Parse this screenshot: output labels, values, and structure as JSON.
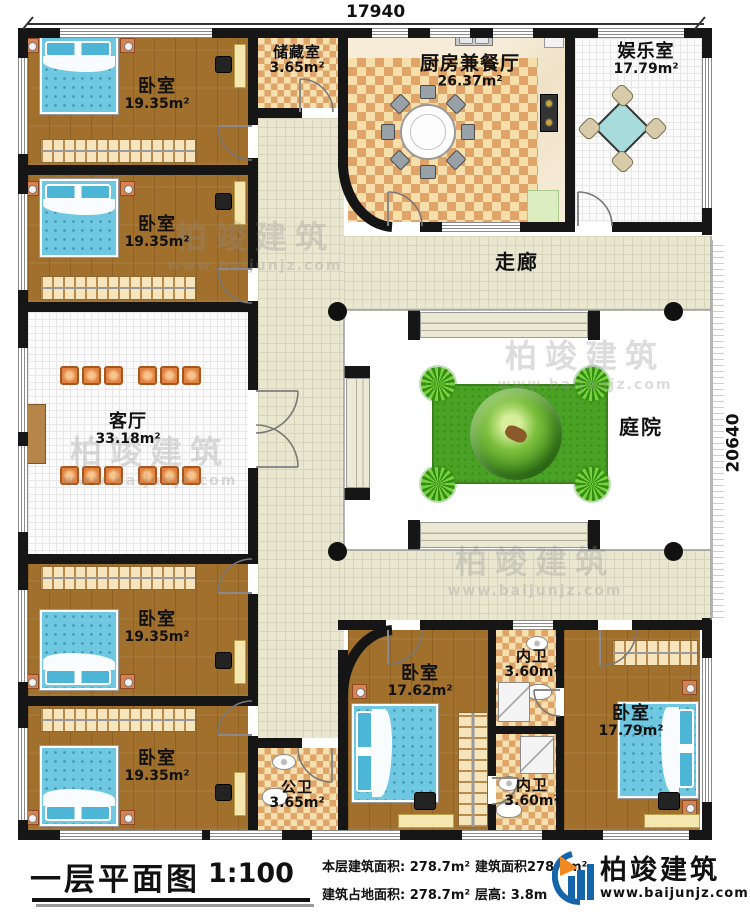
{
  "dimensions": {
    "top": "17940",
    "right": "20640"
  },
  "rooms": [
    {
      "id": "bedroom-1",
      "name": "卧室",
      "area": "19.35m²"
    },
    {
      "id": "bedroom-2",
      "name": "卧室",
      "area": "19.35m²"
    },
    {
      "id": "storage",
      "name": "储藏室",
      "area": "3.65m²"
    },
    {
      "id": "kitchen-dining",
      "name": "厨房兼餐厅",
      "area": "26.37m²"
    },
    {
      "id": "entertainment",
      "name": "娱乐室",
      "area": "17.79m²"
    },
    {
      "id": "corridor",
      "name": "走廊",
      "area": ""
    },
    {
      "id": "living-room",
      "name": "客厅",
      "area": "33.18m²"
    },
    {
      "id": "courtyard",
      "name": "庭院",
      "area": ""
    },
    {
      "id": "bedroom-3",
      "name": "卧室",
      "area": "19.35m²"
    },
    {
      "id": "bedroom-4",
      "name": "卧室",
      "area": "19.35m²"
    },
    {
      "id": "public-bath",
      "name": "公卫",
      "area": "3.65m²"
    },
    {
      "id": "bedroom-5",
      "name": "卧室",
      "area": "17.62m²"
    },
    {
      "id": "ensuite-bath-1",
      "name": "内卫",
      "area": "3.60m²"
    },
    {
      "id": "ensuite-bath-2",
      "name": "内卫",
      "area": "3.60m²"
    },
    {
      "id": "bedroom-6",
      "name": "卧室",
      "area": "17.79m²"
    }
  ],
  "titlebar": {
    "title": "一层平面图",
    "scale": "1:100",
    "stats": [
      "本层建筑面积: 278.7m²",
      "建筑占地面积: 278.7m²",
      "建筑面积278.7m²",
      "层高: 3.8m"
    ]
  },
  "logo": {
    "brand": "柏竣建筑",
    "url": "www.baijunjz.com"
  },
  "watermark": {
    "brand": "柏竣建筑",
    "url": "www.baijunjz.com"
  }
}
